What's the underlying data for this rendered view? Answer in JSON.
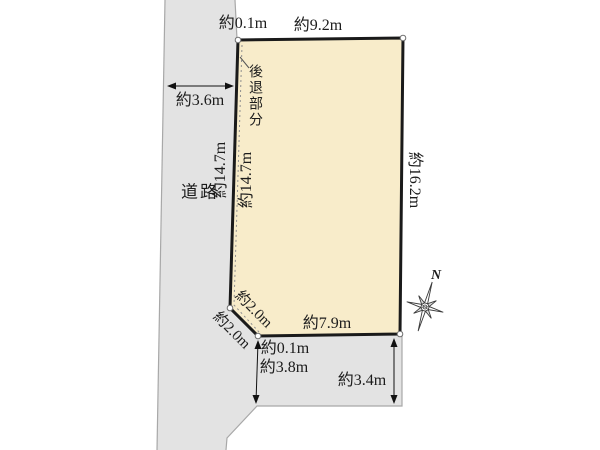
{
  "diagram": {
    "type": "land-plot-site-plan",
    "road_label": "道路",
    "setback_label": "後退部分",
    "north_label": "N",
    "measurements": {
      "top_offset": "約0.1m",
      "top_edge": "約9.2m",
      "road_width": "約3.6m",
      "left_edge_road_side": "約14.7m",
      "left_edge_lot_side": "約14.7m",
      "right_edge": "約16.2m",
      "corner_cut_lot": "約2.0m",
      "corner_cut_road": "約2.0m",
      "bottom_edge": "約7.9m",
      "bottom_offset": "約0.1m",
      "bottom_road_width_left": "約3.8m",
      "bottom_road_width_right": "約3.4m"
    },
    "colors": {
      "lot_fill": "#f8ecca",
      "road_fill": "#e3e3e3",
      "boundary": "#1a1a1a",
      "road_edge": "#a8a8a8",
      "marker_fill": "#ffffff"
    }
  }
}
